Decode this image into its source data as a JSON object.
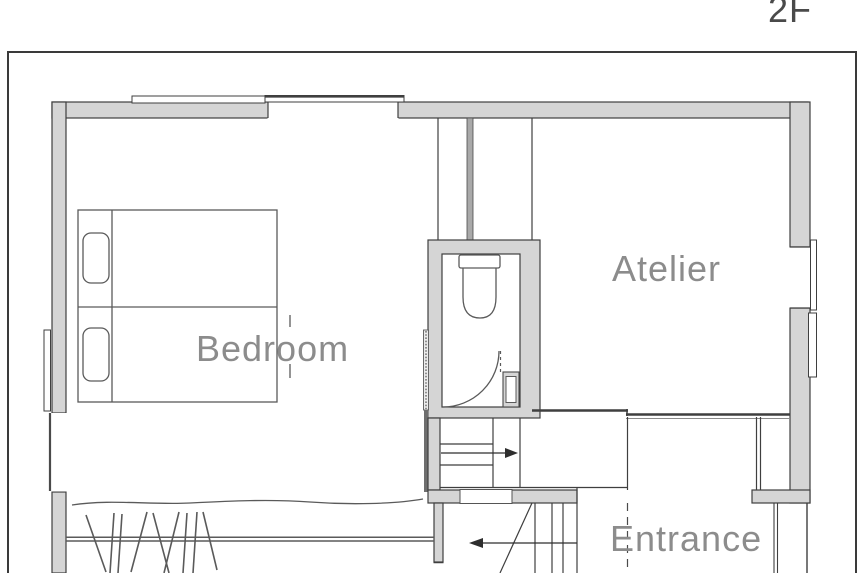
{
  "title": "2F floor plan",
  "floor_label": "2F",
  "rooms": {
    "bedroom": "Bedroom",
    "atelier": "Atelier",
    "entrance": "Entrance"
  },
  "fixtures": {
    "bed": "twin-bed-with-two-pillows",
    "toilet": "toilet-with-tank",
    "toilet_door": "quarter-circle-door-swing",
    "hand_basin": "small-basin-box",
    "stairs_upper": "stair-run-arrow-right",
    "stairs_lower": "stair-run-arrow-left",
    "break_line": "wavy-break-line-with-hatching"
  },
  "colors": {
    "background": "#ffffff",
    "wall_fill": "#d5d5d5",
    "wall_line": "#3f3f3f",
    "fixture_line": "#5a5a5a",
    "room_label_text": "#8c8c8c",
    "floor_label_text": "#4a4a4a"
  }
}
